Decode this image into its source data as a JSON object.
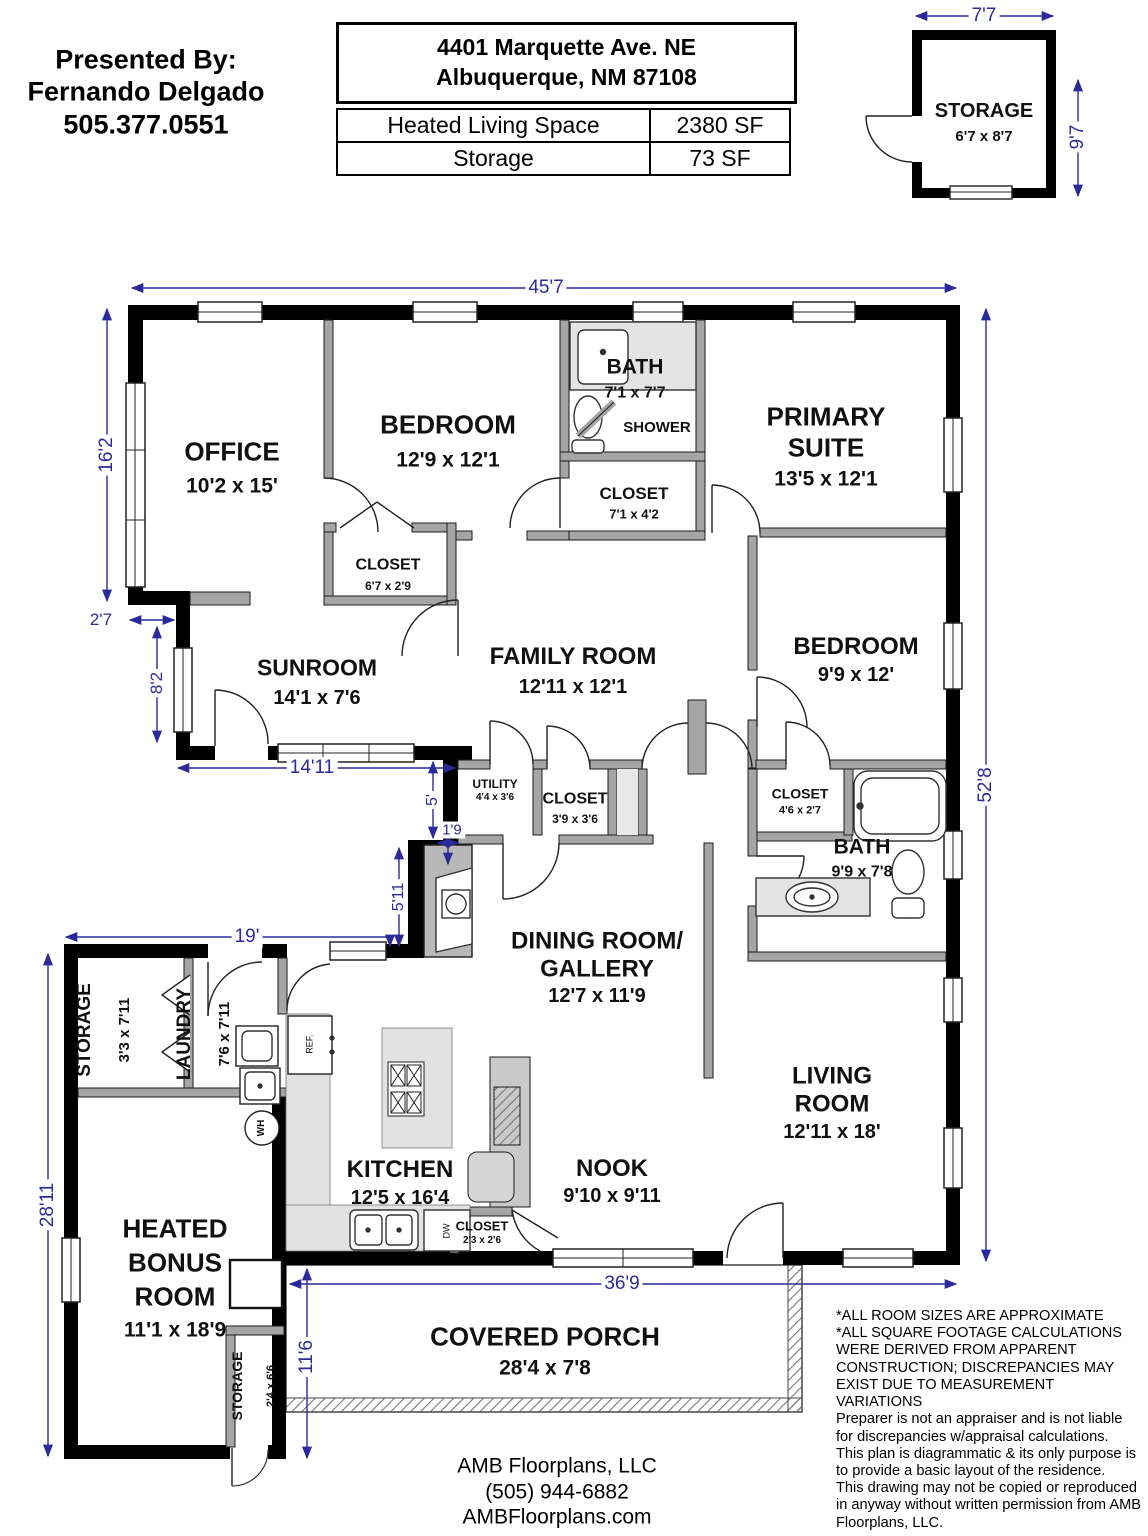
{
  "header": {
    "presented_by": "Presented By:\nFernando Delgado\n505.377.0551",
    "address_line1": "4401 Marquette Ave. NE",
    "address_line2": "Albuquerque, NM 87108",
    "area_table": {
      "rows": [
        {
          "label": "Heated Living Space",
          "value": "2380 SF"
        },
        {
          "label": "Storage",
          "value": "73 SF"
        }
      ]
    }
  },
  "outbuilding": {
    "name": "STORAGE",
    "dims": "6'7 x 8'7",
    "width_dim": "7'7",
    "height_dim": "9'7"
  },
  "rooms": [
    {
      "name": "OFFICE",
      "dims": "10'2 x 15'"
    },
    {
      "name": "BEDROOM",
      "dims": "12'9 x 12'1"
    },
    {
      "name": "BATH",
      "dims": "7'1 x 7'7"
    },
    {
      "name": "SHOWER",
      "dims": ""
    },
    {
      "name": "PRIMARY\nSUITE",
      "dims": "13'5 x 12'1"
    },
    {
      "name": "CLOSET",
      "dims": "7'1 x 4'2"
    },
    {
      "name": "CLOSET",
      "dims": "6'7 x 2'9"
    },
    {
      "name": "SUNROOM",
      "dims": "14'1 x 7'6"
    },
    {
      "name": "FAMILY ROOM",
      "dims": "12'11 x 12'1"
    },
    {
      "name": "BEDROOM",
      "dims": "9'9 x 12'"
    },
    {
      "name": "UTILITY",
      "dims": "4'4 x 3'6"
    },
    {
      "name": "CLOSET",
      "dims": "3'9 x 3'6"
    },
    {
      "name": "CLOSET",
      "dims": "4'6 x 2'7"
    },
    {
      "name": "BATH",
      "dims": "9'9 x 7'8"
    },
    {
      "name": "DINING ROOM/\nGALLERY",
      "dims": "12'7 x 11'9"
    },
    {
      "name": "LIVING\nROOM",
      "dims": "12'11 x 18'"
    },
    {
      "name": "STORAGE",
      "dims": "3'3 x 7'11"
    },
    {
      "name": "LAUNDRY",
      "dims": "7'6 x 7'11"
    },
    {
      "name": "KITCHEN",
      "dims": "12'5 x 16'4"
    },
    {
      "name": "NOOK",
      "dims": "9'10 x 9'11"
    },
    {
      "name": "CLOSET",
      "dims": "2'3 x 2'6"
    },
    {
      "name": "HEATED\nBONUS\nROOM",
      "dims": "11'1 x 18'9"
    },
    {
      "name": "STORAGE",
      "dims": "2'4 x 6'6"
    },
    {
      "name": "COVERED PORCH",
      "dims": "28'4 x 7'8"
    }
  ],
  "fixtures": {
    "water_heater": "WH",
    "refrigerator": "REF.",
    "dishwasher": "DW"
  },
  "dimensions": {
    "overall_width": "45'7",
    "office_height": "16'2",
    "left_jog": "2'7",
    "sunroom_height": "8'2",
    "sunroom_width": "14'11",
    "mid_jog_height": "5'",
    "mid_jog_width": "1'9",
    "mid_wall": "5'11",
    "wing_width": "19'",
    "wing_height": "28'11",
    "porch_side": "11'6",
    "bottom_width": "36'9",
    "overall_height": "52'8"
  },
  "notes": "*ALL ROOM SIZES ARE APPROXIMATE\n*ALL SQUARE FOOTAGE CALCULATIONS\nWERE DERIVED FROM APPARENT\nCONSTRUCTION; DISCREPANCIES MAY\nEXIST DUE TO MEASUREMENT\nVARIATIONS\nPreparer is not an appraiser and is not liable\nfor discrepancies w/appraisal calculations.\nThis plan is diagrammatic & its only purpose is\nto provide a basic layout of the residence.\nThis drawing may not be copied or reproduced\nin anyway without written permission from AMB\nFloorplans, LLC.",
  "footer": {
    "company_block": "AMB Floorplans, LLC\n(505) 944-6882\nAMBFloorplans.com"
  },
  "colors": {
    "dimension_color": "#2a2a9a",
    "wall_color": "#000000",
    "interior_wall_color": "#a5a5a5"
  }
}
